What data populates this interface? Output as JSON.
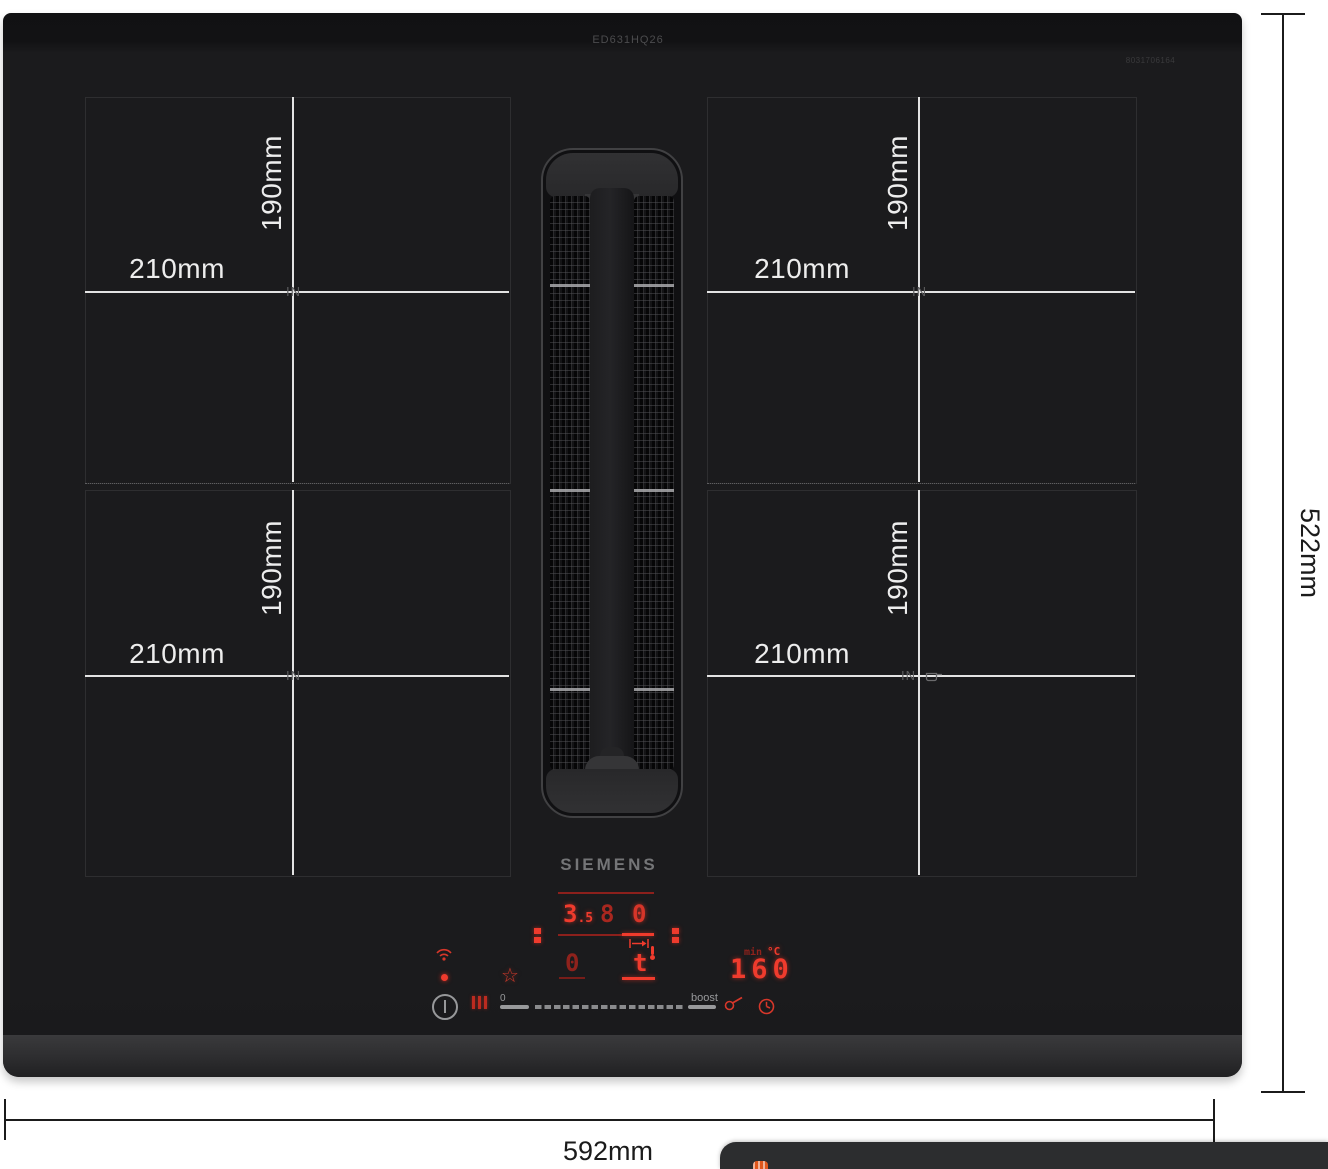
{
  "header": {
    "model_code": "ED631HQ26",
    "corner_code": "8031706164"
  },
  "brand": {
    "logo": "SIEMENS"
  },
  "zones": {
    "height_label": "190mm",
    "width_label": "210mm",
    "induction_marker": "IN"
  },
  "dimensions": {
    "width_label": "592mm",
    "height_label": "522mm"
  },
  "control_panel": {
    "display": {
      "power_left_main": "3",
      "power_left_sub": ".5",
      "power_center": "8",
      "power_right": "0",
      "vent_level": "0",
      "vent_mode": "t",
      "temperature": "160",
      "temperature_unit": "°C",
      "timer_unit": "min"
    },
    "slider": {
      "zero_label": "0",
      "boost_label": "boost"
    },
    "icons": {
      "favorite_star": "☆"
    }
  },
  "colors": {
    "led_red": "#ef3b2d",
    "led_dim_red": "#8c201c",
    "crosshair_white": "#e3e3e3",
    "panel_gray": "#98999b",
    "banner_bg": "#2c2d2f",
    "cookie_orange": "#e0571c"
  }
}
